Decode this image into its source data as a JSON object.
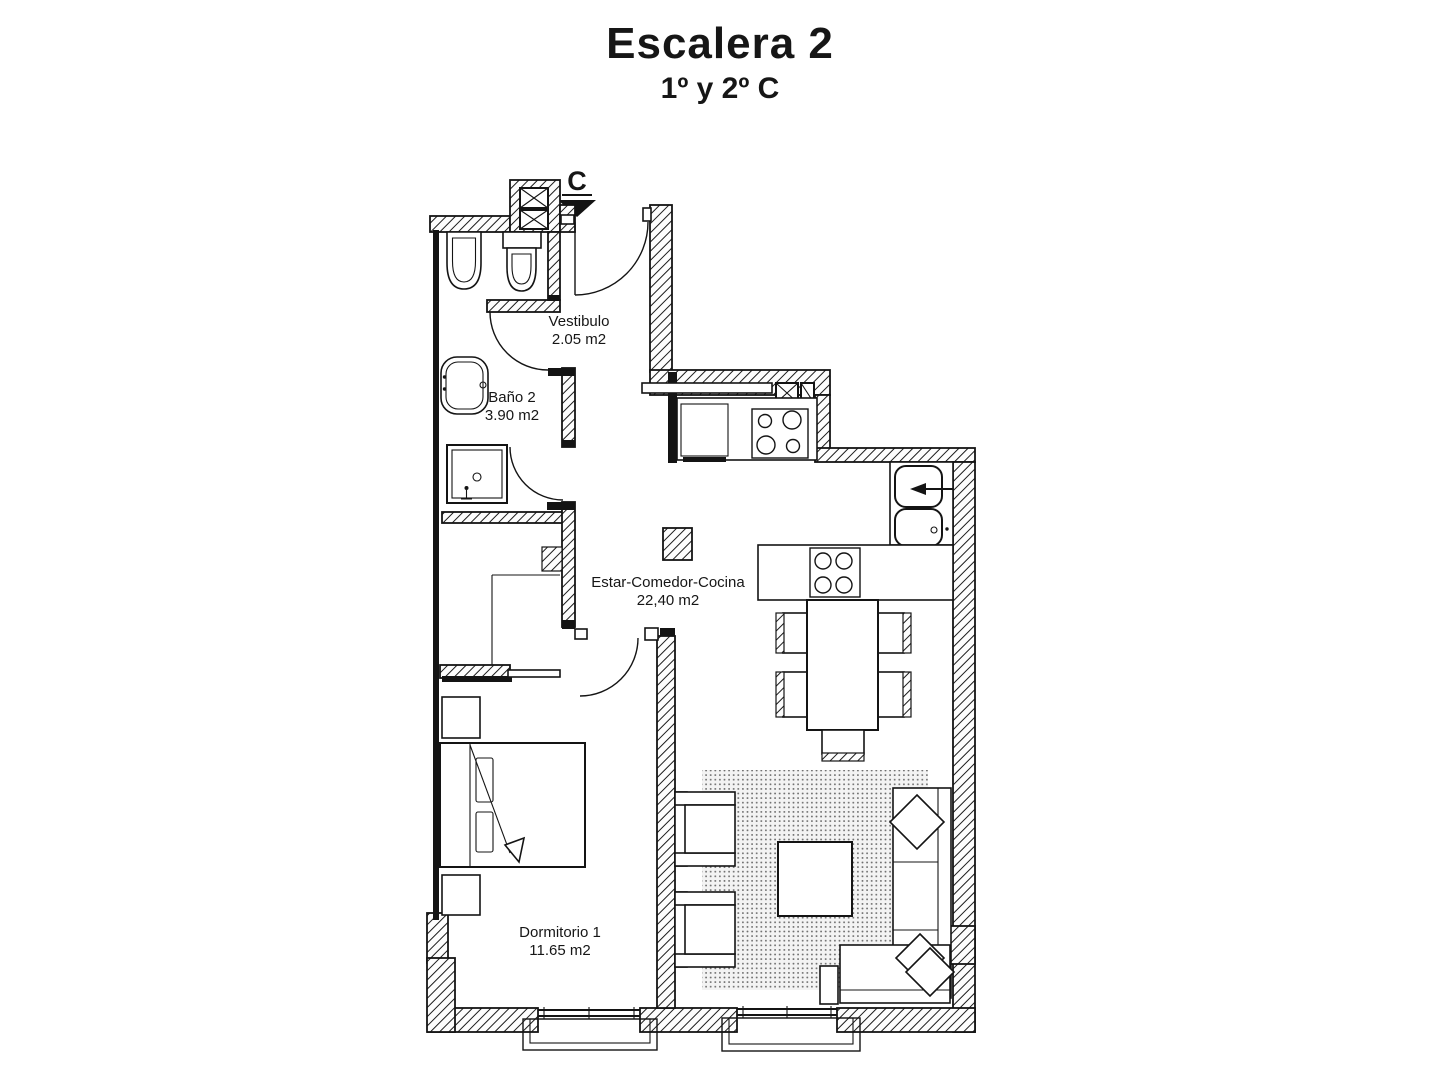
{
  "page": {
    "background": "#ffffff",
    "ink_color": "#161616",
    "wall_style": "diagonal-hatch",
    "rug_style": "stipple-dots"
  },
  "header": {
    "title": "Escalera 2",
    "subtitle": "1º y 2º C"
  },
  "plan": {
    "entrance_marker": "C",
    "rooms": [
      {
        "name": "Vestibulo",
        "area": "2.05 m2"
      },
      {
        "name": "Baño 2",
        "area": "3.90 m2"
      },
      {
        "name": "Estar-Comedor-Cocina",
        "area": "22,40 m2"
      },
      {
        "name": "Dormitorio 1",
        "area": "11.65 m2"
      }
    ],
    "symbols": [
      "entrance-arrow",
      "door-swing-arc",
      "ventilation-shaft",
      "structural-pillar",
      "bidet",
      "toilet",
      "washbasin",
      "shower-tray",
      "built-in-wardrobe",
      "fridge",
      "hob-4-burners",
      "kitchen-counter",
      "double-sink",
      "peninsula-counter",
      "dining-table",
      "dining-chair",
      "rug",
      "coffee-table",
      "corner-sofa",
      "cushion",
      "armchair",
      "side-table",
      "double-bed",
      "pillow",
      "nightstand",
      "window",
      "window-sill"
    ]
  }
}
